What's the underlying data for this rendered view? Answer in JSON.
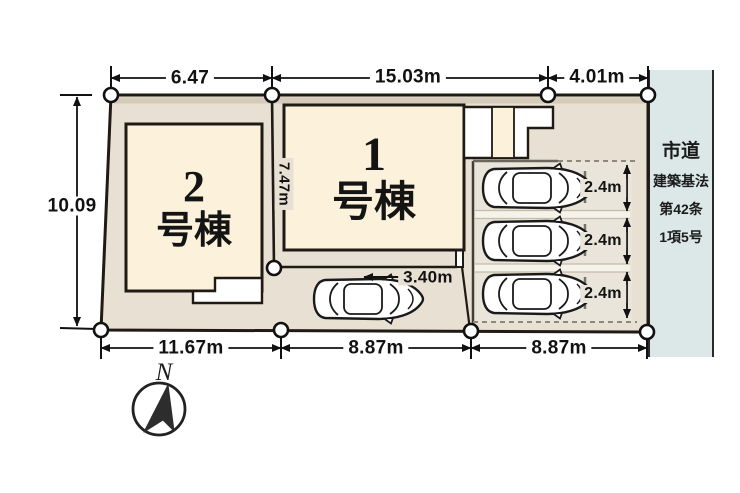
{
  "site_plan": {
    "buildings": [
      {
        "number": "1",
        "suffix": "号棟"
      },
      {
        "number": "2",
        "suffix": "号棟"
      }
    ],
    "dimensions": {
      "top": [
        "6.47",
        "15.03m",
        "4.01m"
      ],
      "left": "10.09",
      "bottom": [
        "11.67m",
        "8.87m",
        "8.87m"
      ],
      "building1_depth": "7.47m",
      "car_space_width": "3.40m",
      "parking_stalls": [
        "2.4m",
        "2.4m",
        "2.4m"
      ]
    },
    "road": {
      "lines": [
        "市道",
        "建築基法",
        "第42条",
        "1項5号"
      ]
    },
    "compass": {
      "north_label": "N"
    },
    "colors": {
      "lot": "#e8e0d3",
      "building": "#fcf2dc",
      "road": "#dce8e7",
      "parking": "#eae5da",
      "outline": "#1f1a13"
    }
  }
}
